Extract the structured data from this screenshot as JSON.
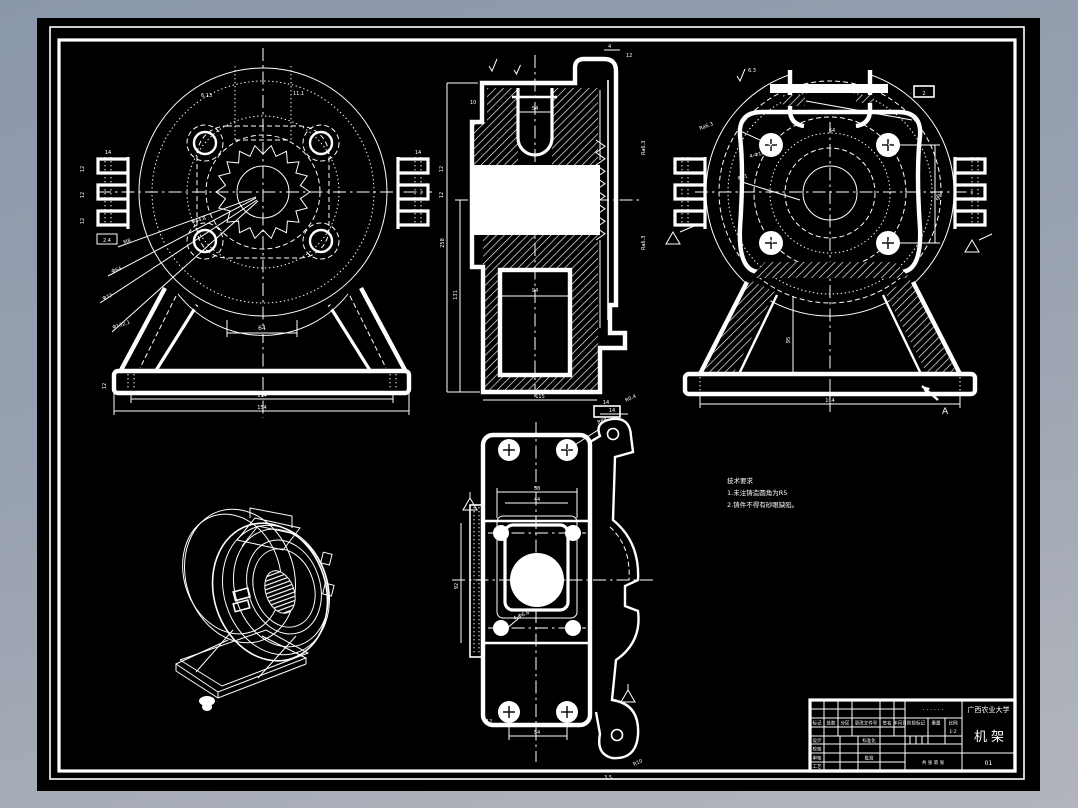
{
  "window": {
    "kind": "CAD drawing sheet",
    "part": "机架"
  },
  "colors": {
    "bg_top": "#8b97ab",
    "bg_bottom": "#b2b5bc",
    "sheet": "#000000",
    "line": "#ffffff"
  },
  "notes": {
    "title": "技术要求",
    "line1": "1.未注铸造圆角为R5",
    "line2": "2.铸件不得有砂眼缺陷。"
  },
  "title_block": {
    "school": "广西农业大学",
    "part_name": "机架",
    "drawing_no_dots": "· · · · · ·",
    "sheet_no": "01",
    "col_mark": "标记",
    "col_count": "处数",
    "col_zone": "分区",
    "col_doc": "更改文件号",
    "col_sign": "签名",
    "col_date": "年月日",
    "row_design": "设计",
    "row_check": "校核",
    "row_audit": "审核",
    "row_process": "工艺",
    "row_std": "标准化",
    "row_approve": "批准",
    "stage": "阶段标记",
    "weight": "重量",
    "scale": "比例",
    "scale_val": "1:2",
    "sheets": "共 张  第 张"
  },
  "front": {
    "labels": [
      "64",
      "114",
      "154",
      "12",
      "14",
      "12",
      "2.4",
      "6.13",
      "11.1",
      "M8",
      "Φ64",
      "Φ77",
      "Φ132.1",
      "Φ44.8"
    ]
  },
  "section": {
    "labels": [
      "54",
      "94",
      "258",
      "131",
      "10",
      "4",
      "14",
      "R0.4",
      "Ra6.3",
      "12",
      "115"
    ]
  },
  "rear": {
    "labels": [
      "95",
      "164",
      "A",
      "2",
      "6.3",
      "4-Φ10",
      "Φ91",
      "96",
      "64",
      "Ra6.3"
    ]
  },
  "plan": {
    "labels": [
      "58",
      "44",
      "92",
      "54",
      "14",
      "R88",
      "4-Φ6.6",
      "3.5",
      "R10",
      "12"
    ]
  }
}
